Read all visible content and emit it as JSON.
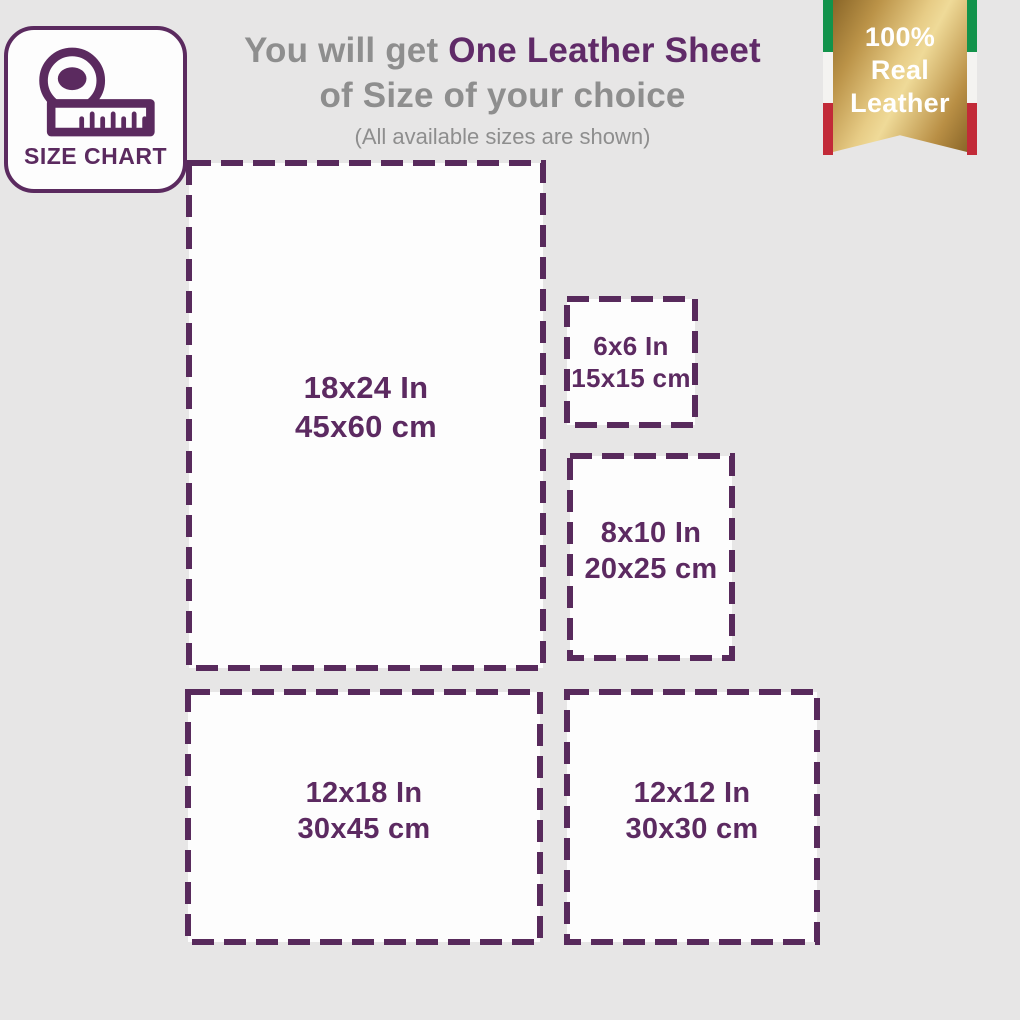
{
  "badge": {
    "label": "SIZE CHART"
  },
  "heading": {
    "prefix": "You will get ",
    "highlight": "One Leather Sheet",
    "line2": "of Size of your choice",
    "subtitle": "(All available sizes are shown)"
  },
  "ribbon": {
    "lines": [
      "100%",
      "Real",
      "Leather"
    ],
    "colors": {
      "gold_light": "#efda98",
      "gold_dark": "#8a6628",
      "flag_green": "#12934b",
      "flag_white": "#f4f3f1",
      "flag_red": "#c22a38"
    }
  },
  "sizes": [
    {
      "inch": "18x24 In",
      "cm": "45x60 cm"
    },
    {
      "inch": "6x6 In",
      "cm": "15x15 cm"
    },
    {
      "inch": "8x10 In",
      "cm": "20x25 cm"
    },
    {
      "inch": "12x18 In",
      "cm": "30x45 cm"
    },
    {
      "inch": "12x12 In",
      "cm": "30x30 cm"
    }
  ],
  "colors": {
    "purple": "#5c2a61",
    "purple_heading": "#602a68",
    "gray_text": "#8e8e8e",
    "background": "#e7e6e6",
    "box_fill": "#fdfdfd"
  }
}
